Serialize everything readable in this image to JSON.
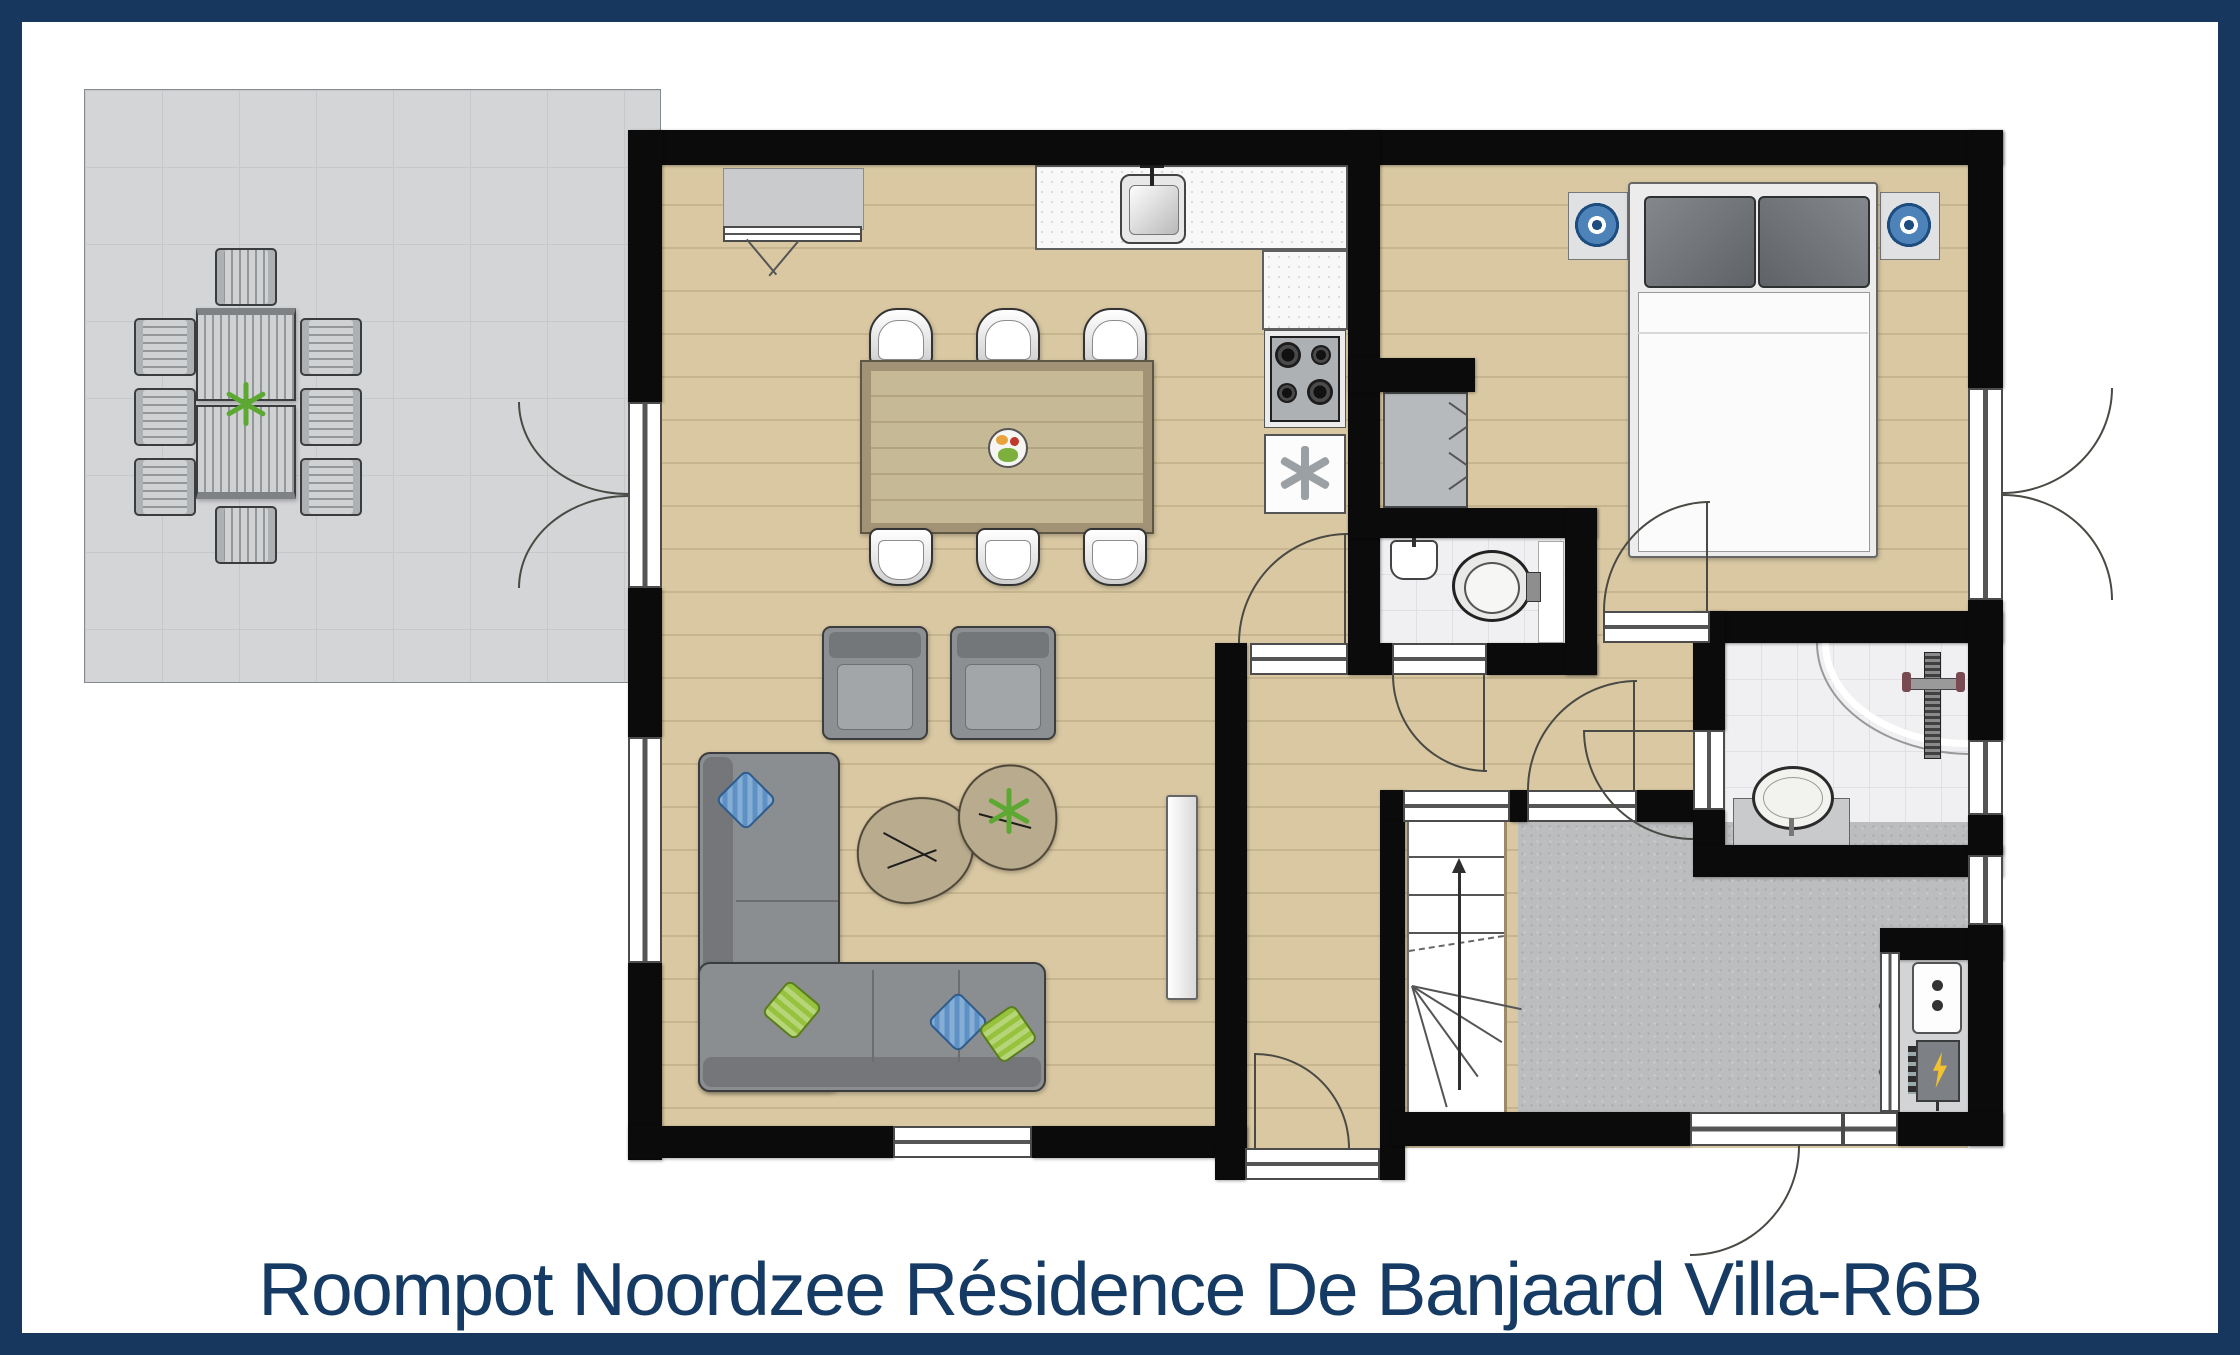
{
  "title": {
    "text": "Roompot Noordzee Résidence De Banjaard Villa-R6B"
  },
  "colors": {
    "navy": "#17375E",
    "title-text": "#153A63",
    "wall": "#0B0B0B",
    "line": "#4A4A44",
    "wood": "#D9C8A2",
    "terrace-gray": "#D3D5D7",
    "hall-gray": "#BCBDBF",
    "tile-white": "#F0F0F2",
    "sofa-gray": "#8B8E91",
    "pillow-blue": "#5E92C6",
    "pillow-green": "#96C23E",
    "lamp-blue": "#4D83B8",
    "plant-green": "#5DA832",
    "bolt-yellow": "#F2C230"
  },
  "floor_plan": {
    "rooms": [
      {
        "name": "terrace",
        "floor": "gray-tiles"
      },
      {
        "name": "living-dining-room",
        "floor": "wood"
      },
      {
        "name": "open-kitchen",
        "floor": "wood"
      },
      {
        "name": "bedroom",
        "floor": "wood"
      },
      {
        "name": "bathroom",
        "floor": "white-tile"
      },
      {
        "name": "toilet",
        "floor": "white-tile"
      },
      {
        "name": "hallway",
        "floor": "wood"
      },
      {
        "name": "entrance-hall",
        "floor": "gray-stone"
      },
      {
        "name": "staircase",
        "direction": "up"
      },
      {
        "name": "meter-closet",
        "contents": [
          "boiler",
          "electrical-panel"
        ]
      }
    ],
    "furniture": {
      "terrace": [
        "outdoor-table",
        "outdoor-chairs-x8",
        "plant"
      ],
      "living": [
        "dining-table",
        "dining-chairs-x6",
        "fruit-bowl",
        "armchairs-x2",
        "coffee-tables-x2",
        "corner-sofa",
        "cushions-x4",
        "tv"
      ],
      "kitchen": [
        "counter",
        "sink-with-faucet",
        "gas-hob-4-burners",
        "freezer"
      ],
      "bedroom": [
        "double-bed",
        "pillows-x2",
        "bedside-lamps-x2",
        "wardrobe"
      ],
      "bathroom": [
        "walk-in-shower",
        "shower-drain",
        "shower-mixer",
        "washbasin-on-vanity"
      ],
      "toilet": [
        "toilet-bowl",
        "corner-basin"
      ]
    }
  }
}
